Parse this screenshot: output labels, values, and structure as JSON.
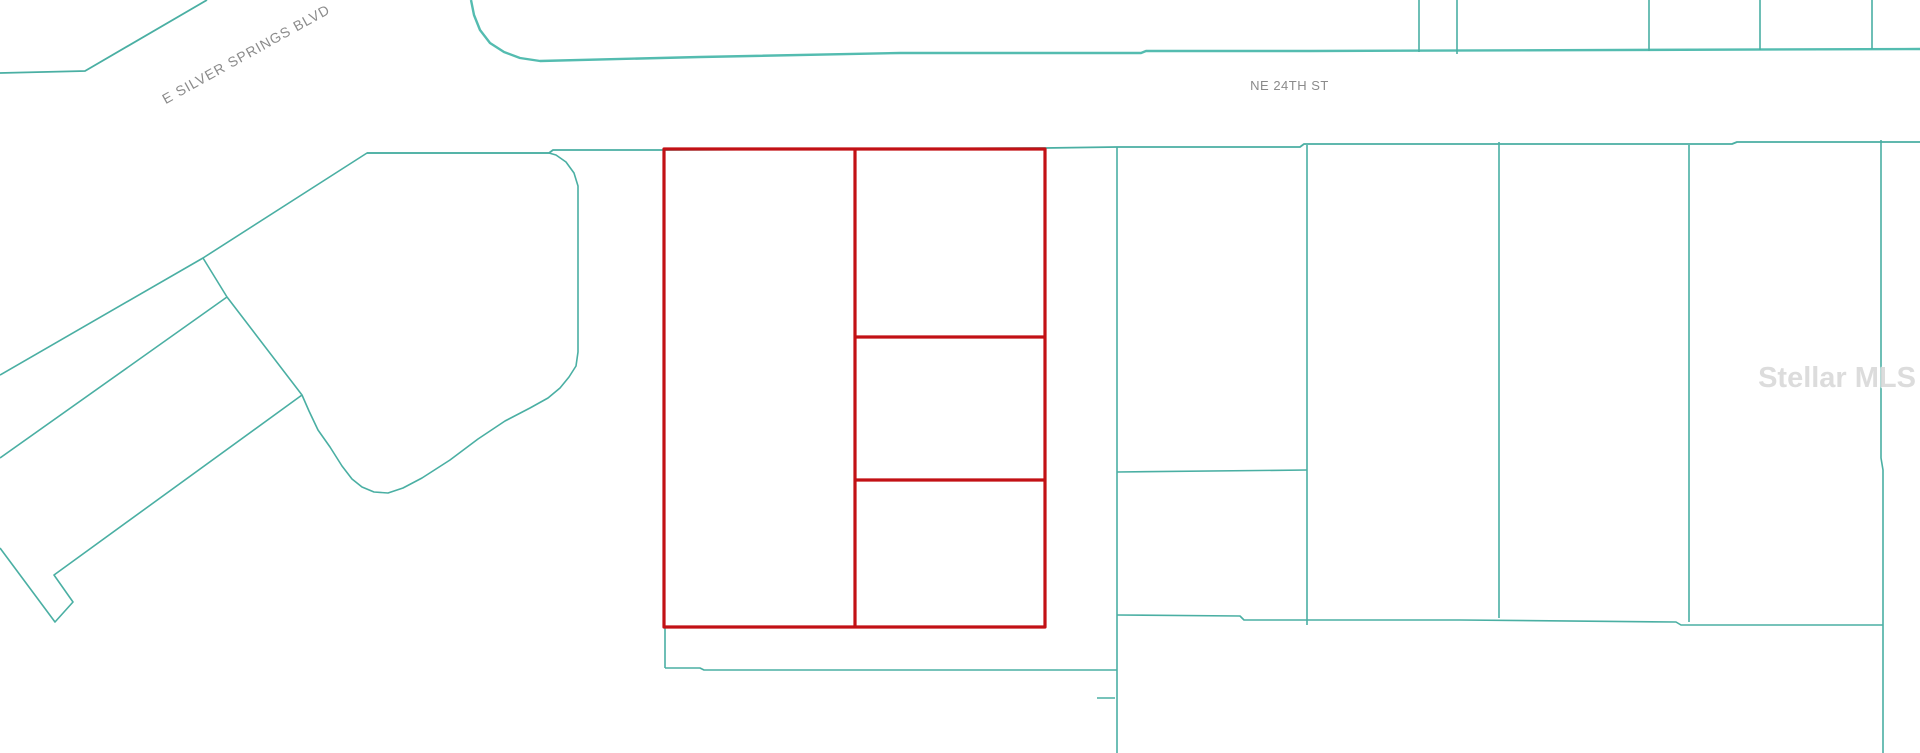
{
  "canvas": {
    "width": 1920,
    "height": 753,
    "background": "#ffffff"
  },
  "colors": {
    "parcel_line": "#4aafa3",
    "road_line": "#54bcb0",
    "highlight": "#c21115",
    "label_text": "#8b8b8b",
    "watermark_text": "#d9d9d9"
  },
  "labels": {
    "street_diagonal": {
      "text": "E SILVER SPRINGS BLVD",
      "left": 146,
      "top": 46,
      "width": 200,
      "angle": -29,
      "font_size": 14,
      "letter_spacing": 1
    },
    "street_horizontal": {
      "text": "NE 24TH ST",
      "left": 1242,
      "top": 78,
      "width": 95,
      "angle": 0,
      "font_size": 13,
      "letter_spacing": 0.5
    },
    "watermark": {
      "text": "Stellar MLS",
      "right": 4,
      "top": 362,
      "angle": 0,
      "font_size": 29,
      "letter_spacing": 0
    }
  },
  "map": {
    "teal_lines": [
      {
        "name": "e-silver-springs-blvd-north-edge",
        "points": [
          [
            0,
            73
          ],
          [
            85,
            71
          ],
          [
            207,
            0
          ]
        ],
        "w": 1.8
      },
      {
        "name": "ne-24th-st-north-edge",
        "color": "road_line",
        "w": 2.4,
        "points": [
          [
            471,
            0
          ],
          [
            474,
            15
          ],
          [
            480,
            30
          ],
          [
            490,
            43
          ],
          [
            504,
            52
          ],
          [
            520,
            58
          ],
          [
            540,
            61
          ],
          [
            700,
            57
          ],
          [
            900,
            53
          ],
          [
            1141,
            53
          ],
          [
            1146,
            51
          ],
          [
            1310,
            51
          ],
          [
            1920,
            49
          ]
        ]
      },
      {
        "name": "north-parcel-divider-1",
        "points": [
          [
            1419,
            0
          ],
          [
            1419,
            52
          ]
        ]
      },
      {
        "name": "north-parcel-divider-2",
        "points": [
          [
            1457,
            0
          ],
          [
            1457,
            54
          ]
        ]
      },
      {
        "name": "north-parcel-divider-3",
        "points": [
          [
            1649,
            0
          ],
          [
            1649,
            51
          ]
        ]
      },
      {
        "name": "north-parcel-divider-4",
        "points": [
          [
            1760,
            0
          ],
          [
            1760,
            50
          ]
        ]
      },
      {
        "name": "north-parcel-divider-5",
        "points": [
          [
            1872,
            0
          ],
          [
            1872,
            49
          ]
        ]
      },
      {
        "name": "south-right-of-way-line",
        "w": 1.8,
        "points": [
          [
            367,
            153
          ],
          [
            549,
            153
          ],
          [
            553,
            150
          ],
          [
            663,
            150
          ],
          [
            1045,
            148
          ],
          [
            1117,
            147
          ],
          [
            1300,
            147
          ],
          [
            1304,
            144
          ],
          [
            1505,
            144
          ],
          [
            1732,
            144
          ],
          [
            1737,
            142
          ],
          [
            1920,
            142
          ]
        ]
      },
      {
        "name": "irregular-parcel-outline",
        "closed": true,
        "w": 1.6,
        "points": [
          [
            367,
            153
          ],
          [
            203,
            258
          ],
          [
            227,
            297
          ],
          [
            302,
            395
          ],
          [
            309,
            411
          ],
          [
            318,
            430
          ],
          [
            330,
            447
          ],
          [
            342,
            466
          ],
          [
            352,
            479
          ],
          [
            362,
            487
          ],
          [
            374,
            492
          ],
          [
            388,
            493
          ],
          [
            403,
            488
          ],
          [
            422,
            478
          ],
          [
            450,
            460
          ],
          [
            478,
            439
          ],
          [
            505,
            421
          ],
          [
            530,
            408
          ],
          [
            548,
            398
          ],
          [
            560,
            388
          ],
          [
            569,
            377
          ],
          [
            576,
            366
          ],
          [
            578,
            352
          ],
          [
            578,
            186
          ],
          [
            574,
            173
          ],
          [
            566,
            162
          ],
          [
            556,
            155
          ],
          [
            549,
            153
          ]
        ]
      },
      {
        "name": "e-silver-springs-blvd-south-edge",
        "points": [
          [
            203,
            258
          ],
          [
            0,
            375
          ]
        ]
      },
      {
        "name": "diagonal-parcel-line-lower",
        "points": [
          [
            227,
            297
          ],
          [
            0,
            458
          ]
        ]
      },
      {
        "name": "diagonal-strip-with-hook",
        "points": [
          [
            302,
            395
          ],
          [
            54,
            575
          ],
          [
            73,
            602
          ],
          [
            55,
            622
          ],
          [
            0,
            548
          ]
        ]
      },
      {
        "name": "subject-parcel-tail-vertical",
        "points": [
          [
            665,
            628
          ],
          [
            665,
            668
          ]
        ]
      },
      {
        "name": "subject-parcel-tail-horizontal",
        "points": [
          [
            665,
            668
          ],
          [
            700,
            668
          ],
          [
            704,
            670
          ],
          [
            1117,
            670
          ]
        ]
      },
      {
        "name": "east-parcel-divider-v1",
        "points": [
          [
            1117,
            147
          ],
          [
            1117,
            753
          ]
        ]
      },
      {
        "name": "east-parcel-divider-v2",
        "points": [
          [
            1307,
            145
          ],
          [
            1307,
            625
          ]
        ]
      },
      {
        "name": "east-parcel-bottom-mid",
        "points": [
          [
            1117,
            472
          ],
          [
            1307,
            470
          ]
        ]
      },
      {
        "name": "east-parcel-divider-v3",
        "points": [
          [
            1499,
            142
          ],
          [
            1499,
            618
          ]
        ]
      },
      {
        "name": "east-parcel-divider-v4",
        "points": [
          [
            1689,
            145
          ],
          [
            1689,
            622
          ]
        ]
      },
      {
        "name": "east-parcel-divider-v5",
        "points": [
          [
            1881,
            140
          ],
          [
            1881,
            458
          ],
          [
            1883,
            470
          ],
          [
            1883,
            753
          ]
        ]
      },
      {
        "name": "south-boundary-line",
        "points": [
          [
            1117,
            615
          ],
          [
            1240,
            616
          ],
          [
            1244,
            620
          ],
          [
            1460,
            620
          ],
          [
            1676,
            622
          ],
          [
            1681,
            625
          ],
          [
            1883,
            625
          ]
        ]
      },
      {
        "name": "small-stub-line",
        "points": [
          [
            1097,
            698
          ],
          [
            1115,
            698
          ]
        ]
      }
    ],
    "red_lines": [
      {
        "name": "subject-parcel-outer-boundary",
        "closed": true,
        "points": [
          [
            664,
            149
          ],
          [
            1045,
            149
          ],
          [
            1045,
            627
          ],
          [
            664,
            627
          ]
        ]
      },
      {
        "name": "subject-parcel-vertical-divider",
        "points": [
          [
            855,
            149
          ],
          [
            855,
            627
          ]
        ]
      },
      {
        "name": "subject-parcel-horizontal-divider-1",
        "points": [
          [
            855,
            337
          ],
          [
            1045,
            337
          ]
        ]
      },
      {
        "name": "subject-parcel-horizontal-divider-2",
        "points": [
          [
            855,
            480
          ],
          [
            1045,
            480
          ]
        ]
      }
    ]
  }
}
